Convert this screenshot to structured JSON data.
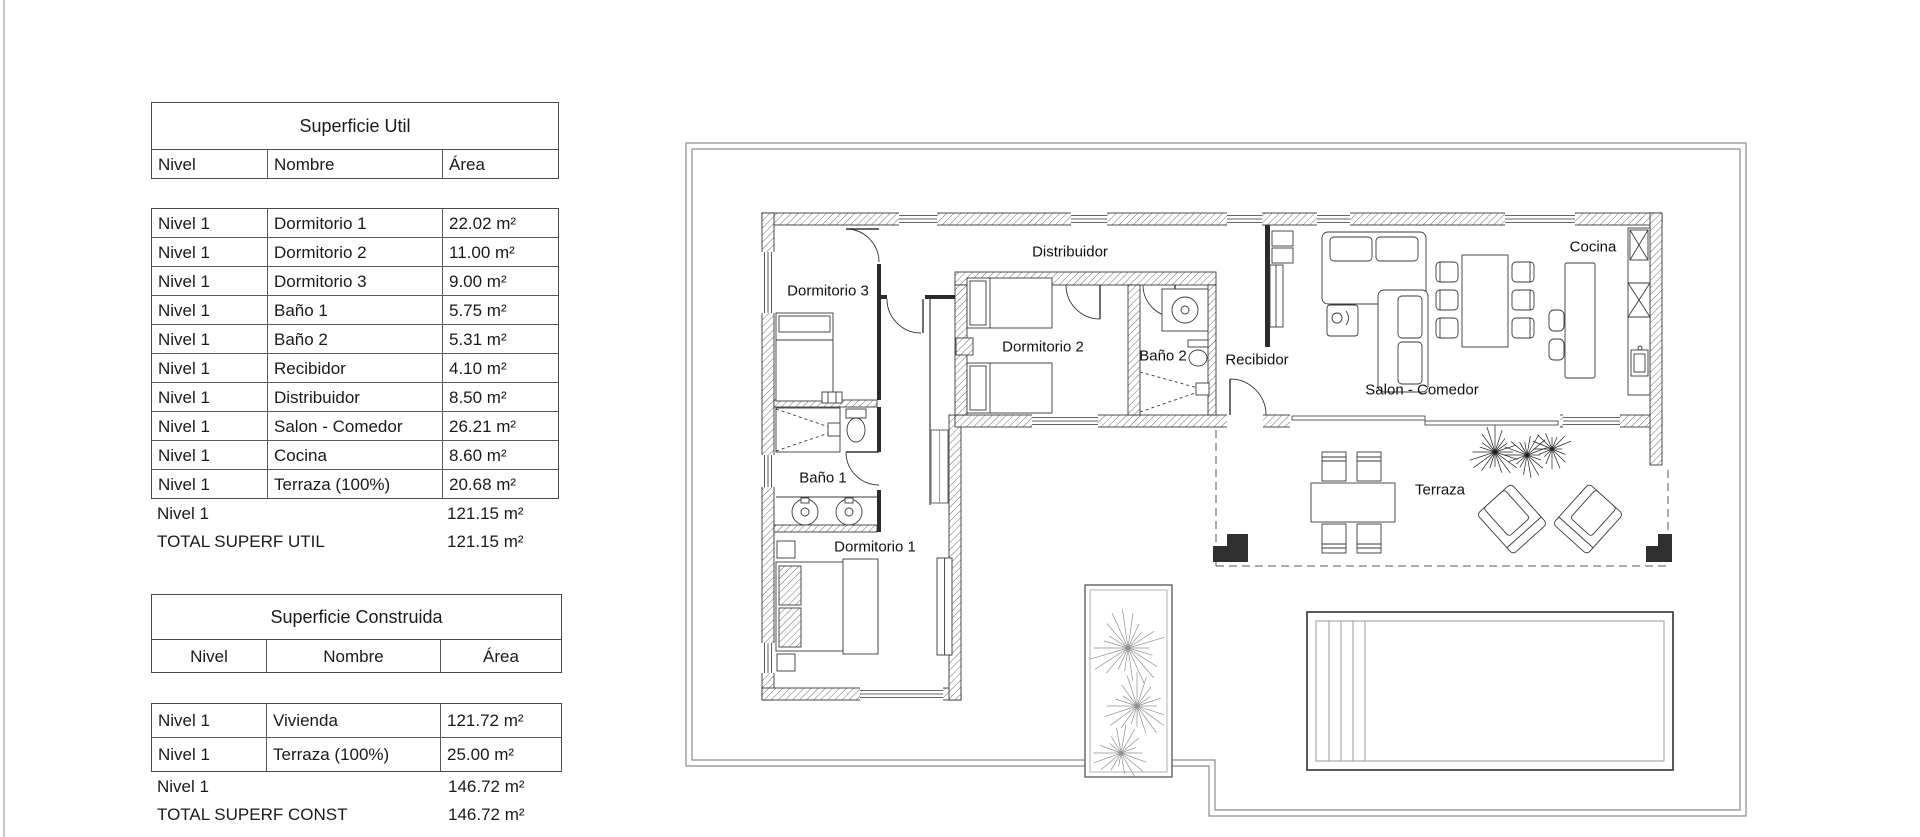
{
  "colors": {
    "background": "#ffffff",
    "drawing_line": "#2b2b2b",
    "boundary_line": "#8c8c8c",
    "table_border": "#4a4a4a"
  },
  "tables": {
    "superficie_util": {
      "title": "Superficie Util",
      "columns": [
        "Nivel",
        "Nombre",
        "Área"
      ],
      "rows": [
        [
          "Nivel 1",
          "Dormitorio 1",
          "22.02 m²"
        ],
        [
          "Nivel 1",
          "Dormitorio 2",
          "11.00 m²"
        ],
        [
          "Nivel 1",
          "Dormitorio 3",
          "9.00 m²"
        ],
        [
          "Nivel 1",
          "Baño 1",
          "5.75 m²"
        ],
        [
          "Nivel 1",
          "Baño 2",
          "5.31 m²"
        ],
        [
          "Nivel 1",
          "Recibidor",
          "4.10 m²"
        ],
        [
          "Nivel 1",
          "Distribuidor",
          "8.50 m²"
        ],
        [
          "Nivel 1",
          "Salon - Comedor",
          "26.21 m²"
        ],
        [
          "Nivel 1",
          "Cocina",
          "8.60 m²"
        ],
        [
          "Nivel 1",
          "Terraza (100%)",
          "20.68 m²"
        ]
      ],
      "subtotal": {
        "label": "Nivel 1",
        "value": "121.15 m²"
      },
      "total": {
        "label": "TOTAL SUPERF UTIL",
        "value": "121.15 m²"
      }
    },
    "superficie_construida": {
      "title": "Superficie Construida",
      "columns": [
        "Nivel",
        "Nombre",
        "Área"
      ],
      "rows": [
        [
          "Nivel 1",
          "Vivienda",
          "121.72 m²"
        ],
        [
          "Nivel 1",
          "Terraza (100%)",
          "25.00 m²"
        ]
      ],
      "subtotal": {
        "label": "Nivel 1",
        "value": "146.72 m²"
      },
      "total": {
        "label": "TOTAL SUPERF CONST",
        "value": "146.72 m²"
      }
    }
  },
  "floor_plan": {
    "labels": {
      "dormitorio1": "Dormitorio 1",
      "dormitorio2": "Dormitorio 2",
      "dormitorio3": "Dormitorio 3",
      "bano1": "Baño 1",
      "bano2": "Baño 2",
      "recibidor": "Recibidor",
      "distribuidor": "Distribuidor",
      "salon_comedor": "Salon - Comedor",
      "cocina": "Cocina",
      "terraza": "Terraza"
    }
  }
}
